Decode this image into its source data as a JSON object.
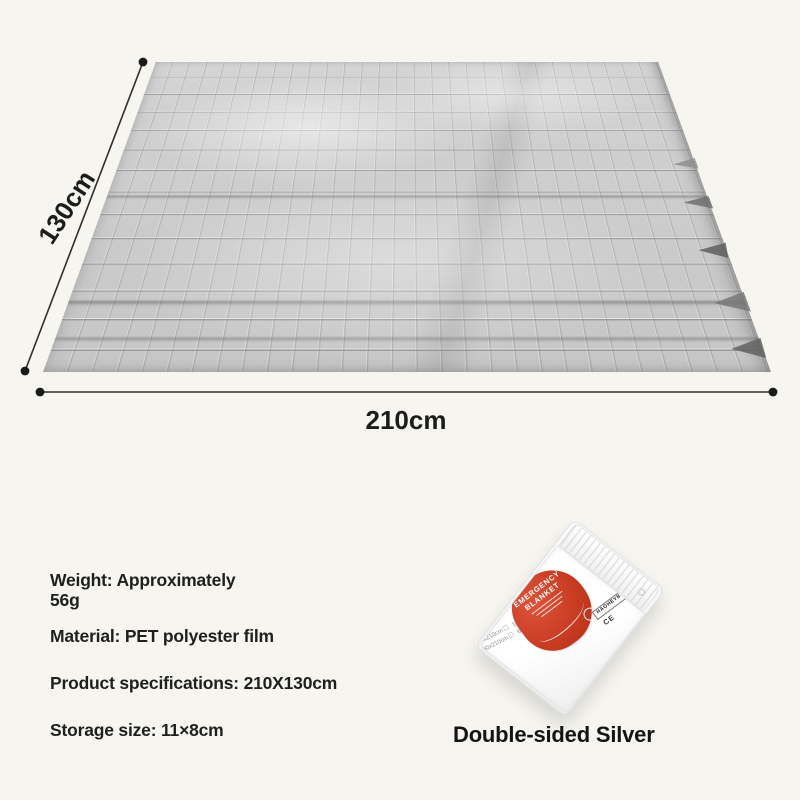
{
  "page": {
    "background_color": "#f6f5f0"
  },
  "diagram": {
    "height_label": "130cm",
    "width_label": "210cm"
  },
  "specs": {
    "weight_line1": "Weight: Approximately",
    "weight_line2": "56g",
    "material": "Material: PET polyester film",
    "product": "Product specifications: 210X130cm",
    "storage": "Storage size: 11×8cm"
  },
  "package": {
    "label_title_line1": "EMERGENCY",
    "label_title_line2": "BLANKET",
    "label_cross_mark": "+",
    "brand_strip": "HAOHEYBO",
    "ce_mark": "CE",
    "size_options": [
      {
        "label": "140x210cm",
        "box": "☐"
      },
      {
        "label": "160x210cm",
        "box": "☐"
      },
      {
        "label": "150x210cm",
        "box": "☐"
      },
      {
        "label": "60x210cm",
        "box": "☑"
      }
    ]
  },
  "caption": "Double-sided Silver",
  "colors": {
    "background": "#f6f5f0",
    "foil_silver": "#cdcdcd",
    "label_red": "#c63a22",
    "annotation_ink": "#1c1c1c"
  }
}
